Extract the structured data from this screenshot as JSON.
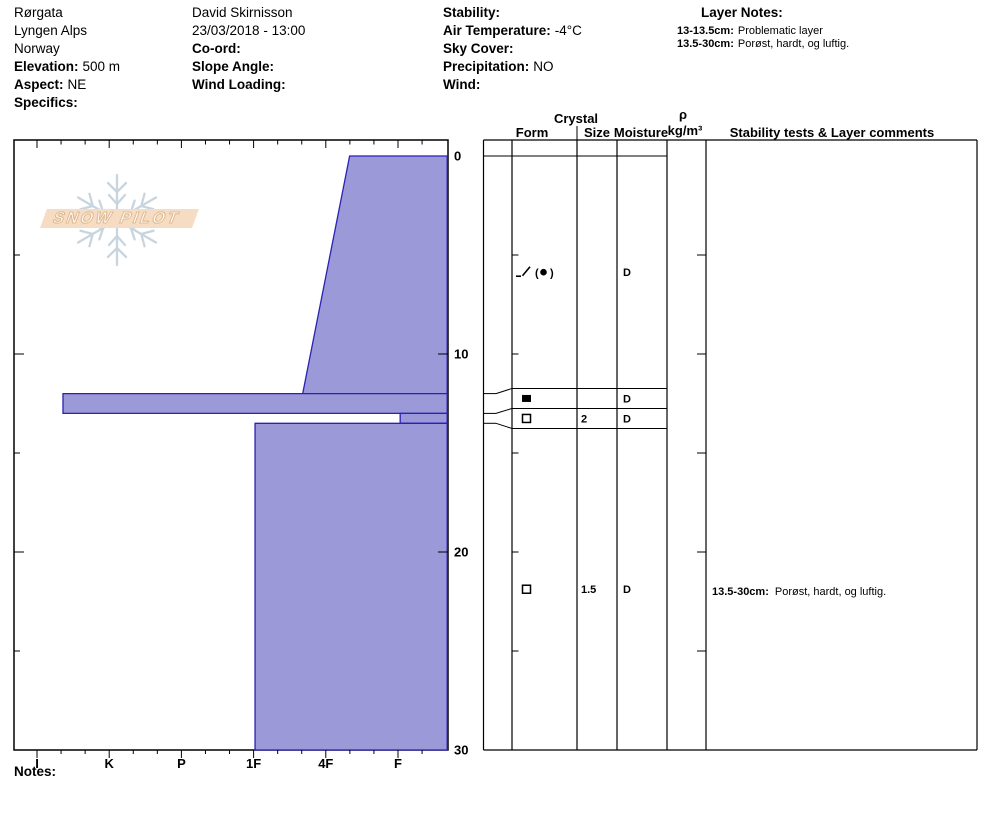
{
  "header": {
    "site": {
      "lines": [
        "Rørgata",
        "Lyngen Alps",
        "Norway"
      ],
      "fields": [
        {
          "label": "Elevation:",
          "value": "500 m"
        },
        {
          "label": "Aspect:",
          "value": "NE"
        },
        {
          "label": "Specifics:",
          "value": ""
        }
      ]
    },
    "observer": {
      "lines": [
        "David Skirnisson",
        "23/03/2018 - 13:00"
      ],
      "fields": [
        {
          "label": "Co-ord:",
          "value": ""
        },
        {
          "label": "Slope Angle:",
          "value": ""
        },
        {
          "label": "Wind Loading:",
          "value": ""
        }
      ]
    },
    "conditions": {
      "fields": [
        {
          "label": "Stability:",
          "value": ""
        },
        {
          "label": "Air Temperature:",
          "value": "-4°C"
        },
        {
          "label": "Sky Cover:",
          "value": ""
        },
        {
          "label": "Precipitation:",
          "value": "NO"
        },
        {
          "label": "Wind:",
          "value": ""
        }
      ]
    },
    "layer_notes": {
      "title": "Layer Notes:",
      "notes": [
        {
          "label": "13-13.5cm:",
          "text": "Problematic layer"
        },
        {
          "label": "13.5-30cm:",
          "text": "Porøst, hardt, og luftig."
        }
      ]
    }
  },
  "logo": {
    "text": "SNOW PILOT",
    "banner_color": "#f5dcc2",
    "snowflake_color": "#c9d5de"
  },
  "table_header": {
    "crystal": "Crystal",
    "form": "Form",
    "size": "Size",
    "moisture": "Moisture",
    "rho": "ρ",
    "rho_unit": "kg/m³",
    "comments": "Stability tests & Layer comments"
  },
  "notes_label": "Notes:",
  "chart_data": {
    "type": "area",
    "title": "Snow pit hardness profile",
    "xlabel": "Hand hardness (hard I at left to soft F at right)",
    "ylabel": "Depth below surface (cm)",
    "hardness_axis": {
      "categories": [
        "I",
        "K",
        "P",
        "1F",
        "4F",
        "F"
      ],
      "minor_ticks_per_major": 3
    },
    "depth_axis": {
      "ticks": [
        "0",
        "10",
        "20",
        "30"
      ],
      "minor_step_cm": 5,
      "range": [
        0,
        30
      ],
      "unit": "cm"
    },
    "total_depth_cm": 30,
    "layers": [
      {
        "top_cm": 0,
        "bottom_cm": 12,
        "hardness_label": "4F-F",
        "hardness_top": 4.33,
        "hardness_bottom": 3.68,
        "form_symbol": "slash-circle",
        "grain_form": "DF (RG)",
        "size_mm": "",
        "moisture": "D",
        "comment_label": "",
        "comment_text": ""
      },
      {
        "top_cm": 12,
        "bottom_cm": 13,
        "hardness_label": "K+",
        "hardness_top": 0.36,
        "hardness_bottom": 0.36,
        "form_symbol": "filled-square",
        "grain_form": "IF ice layer",
        "size_mm": "",
        "moisture": "D",
        "comment_label": "",
        "comment_text": ""
      },
      {
        "top_cm": 13,
        "bottom_cm": 13.5,
        "hardness_label": "F",
        "hardness_top": 5.03,
        "hardness_bottom": 5.03,
        "form_symbol": "open-square",
        "grain_form": "FC facets",
        "size_mm": "2",
        "moisture": "D",
        "comment_label": "",
        "comment_text": ""
      },
      {
        "top_cm": 13.5,
        "bottom_cm": 30,
        "hardness_label": "1F",
        "hardness_top": 3.02,
        "hardness_bottom": 3.02,
        "form_symbol": "open-square",
        "grain_form": "FC facets",
        "size_mm": "1.5",
        "moisture": "D",
        "comment_label": "13.5-30cm:",
        "comment_text": "Porøst, hardt, og luftig."
      }
    ],
    "colors": {
      "layer_fill": "#9b99d8",
      "layer_stroke": "#2823b4",
      "grid": "#000000"
    }
  }
}
